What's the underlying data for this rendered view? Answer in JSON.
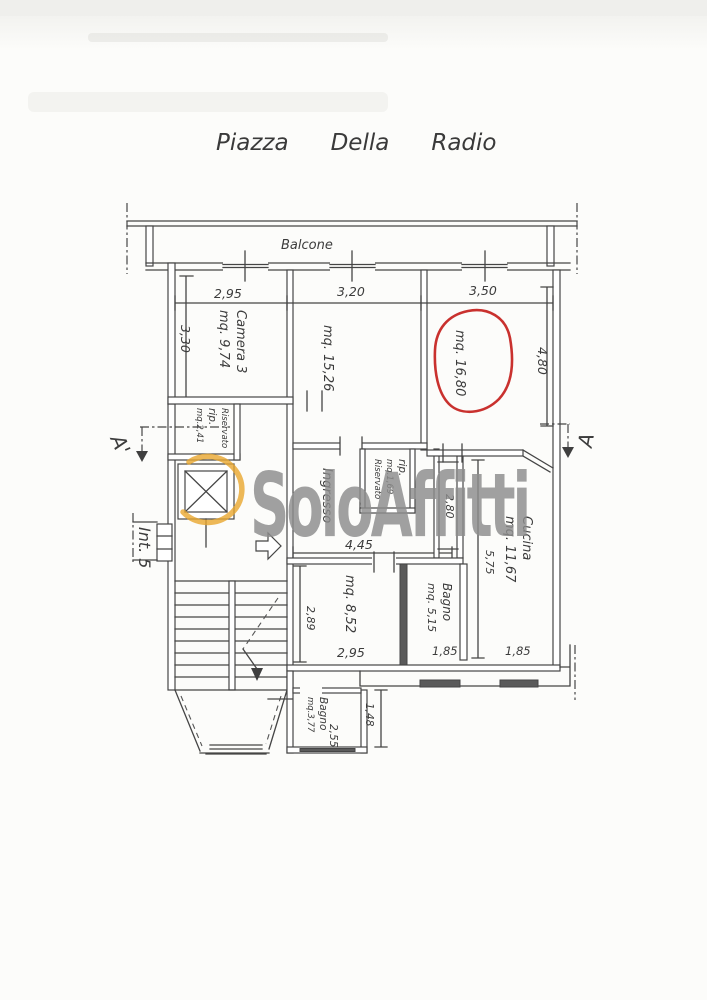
{
  "title": {
    "words": [
      "Piazza",
      "Della",
      "Radio"
    ]
  },
  "watermark": {
    "text": "SoloAffitti"
  },
  "colors": {
    "ink": "#454545",
    "highlight_red": "#c4201c",
    "brand_orange": "#e8a62e",
    "watermark_gray": "#8d8d8d"
  },
  "plan": {
    "balcony_label": "Balcone",
    "unit_label": "Int. 5",
    "section": {
      "left": "A'",
      "right": "A"
    },
    "rooms": {
      "camera3": {
        "name": "Camera 3",
        "area": "mq. 9,74"
      },
      "room2": {
        "area": "mq. 15,26"
      },
      "room3": {
        "area": "mq. 16,80",
        "highlighted": true
      },
      "riservato_top": {
        "line1": "Riservato",
        "line2": "rip.",
        "line3": "mq.2,41"
      },
      "riservato_mid": {
        "line1": "rip.",
        "line2": "mq.1,69",
        "line3": "Riservato"
      },
      "ingresso": {
        "name": "Ingresso"
      },
      "cucina": {
        "name": "Cucina",
        "area": "mq. 11,67"
      },
      "bagno1": {
        "name": "Bagno",
        "area": "mq. 5,15"
      },
      "room_852": {
        "area": "mq. 8,52"
      },
      "bagno2": {
        "name": "Bagno",
        "area": "mq.3,77"
      }
    },
    "dimensions": {
      "top_left": "2,95",
      "top_mid": "3,20",
      "top_right": "3,50",
      "camera3_depth": "3,30",
      "room3_depth": "4,80",
      "corridor": "2,80",
      "hall_width": "4,45",
      "cucina_depth": "5,75",
      "room852_depth": "2,89",
      "room852_width": "2,95",
      "bagno1_width": "1,85",
      "cucina_width": "1,85",
      "bagno2_width": "2,55",
      "bagno2_depth": "1,48"
    }
  }
}
